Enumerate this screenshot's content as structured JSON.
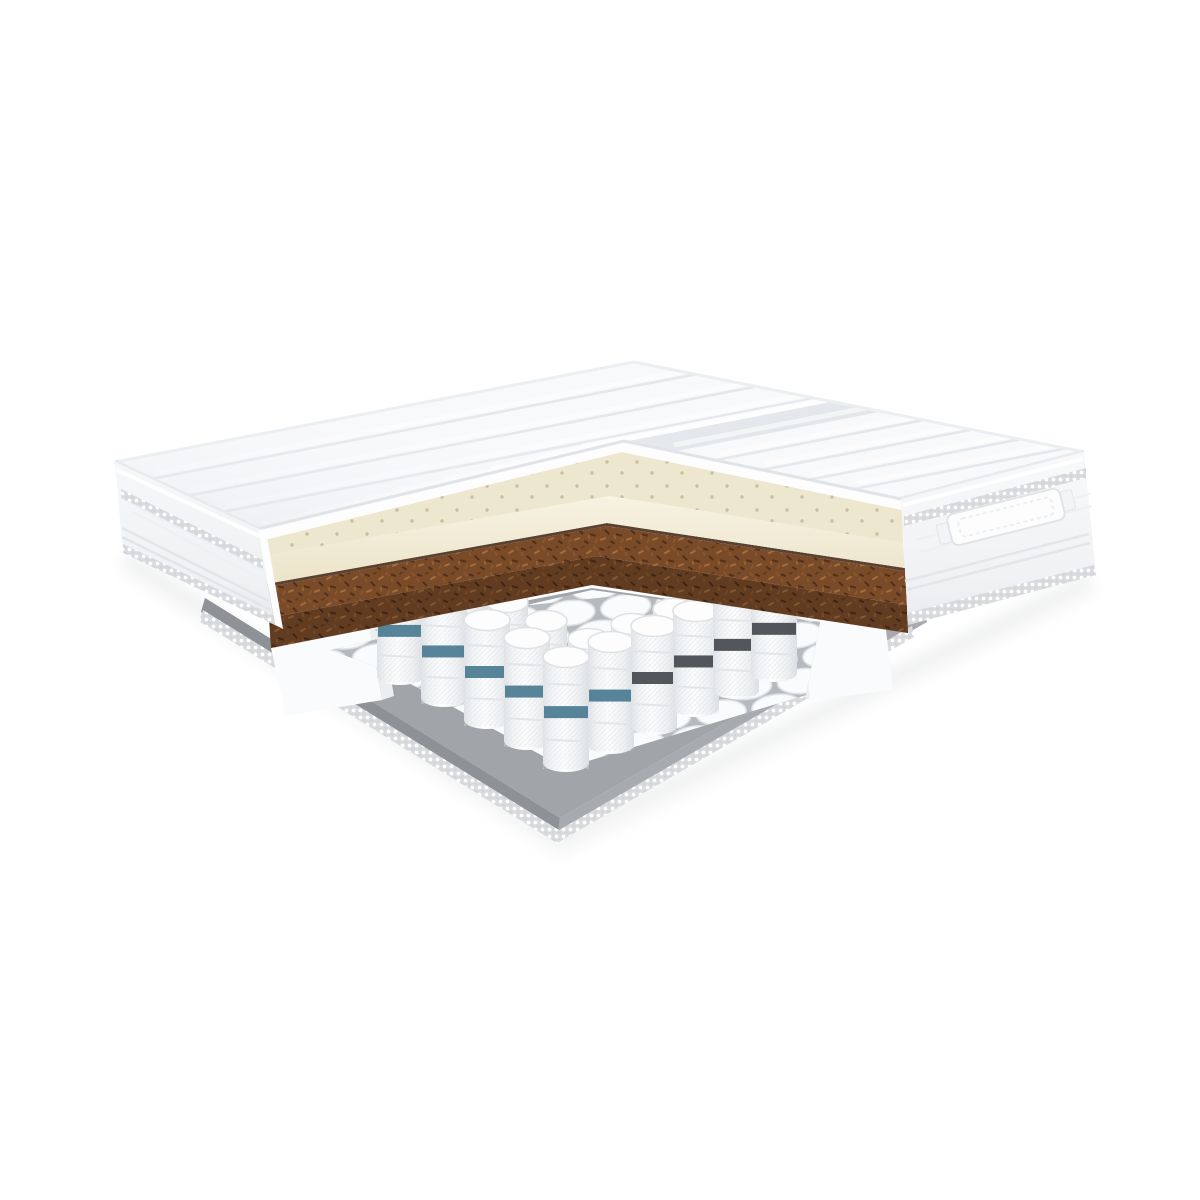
{
  "scene": {
    "title": "mattress-cutaway-render",
    "background": "#ffffff",
    "parts": [
      {
        "name": "quilted-top-cover",
        "label": "Quilted cover"
      },
      {
        "name": "latex-foam-layer",
        "label": "Perforated latex foam layer"
      },
      {
        "name": "coconut-coir-layer",
        "label": "Coconut coir layer"
      },
      {
        "name": "pocket-spring-core",
        "label": "Pocket spring core"
      },
      {
        "name": "foam-encasement-rail",
        "label": "Foam encasement rail"
      },
      {
        "name": "base-pad",
        "label": "Gray base pad"
      },
      {
        "name": "zigzag-trim-tape",
        "label": "Dotted trim tape"
      },
      {
        "name": "side-handle",
        "label": "Fabric side handle"
      }
    ]
  },
  "colors": {
    "background": "#ffffff",
    "cover": "#f8f9fb",
    "cover_shadow": "#e7eaed",
    "stripe": "#e2e5e9",
    "piping": "#e9ecef",
    "panel": "#f4f5f7",
    "panel_deep": "#e8eaed",
    "trim_tape": "#d8dade",
    "trim_dot": "#ffffff",
    "cut_cover_face": "#fdfdfe",
    "latex_top": "#eee7d0",
    "latex_face": "#f4eedb",
    "latex_hole": "#c9bf9f",
    "glue_line": "#5a4130",
    "coir": "#7a4b28",
    "coir_dark": "#512f19",
    "coir_light": "#a36d3e",
    "foam": "#fafbfc",
    "foam_shadow": "#eceef1",
    "spring_white": "#f8f9fb",
    "spring_gap": "#b6b9bd",
    "spring_stroke": "#dfe2e5",
    "band_teal": "#4e7d94",
    "band_dark": "#4a4e53",
    "base_top": "#a1a4a8",
    "base_left": "#8e9195",
    "base_right": "#a7aaae",
    "shadow": "#aeb2b6"
  }
}
